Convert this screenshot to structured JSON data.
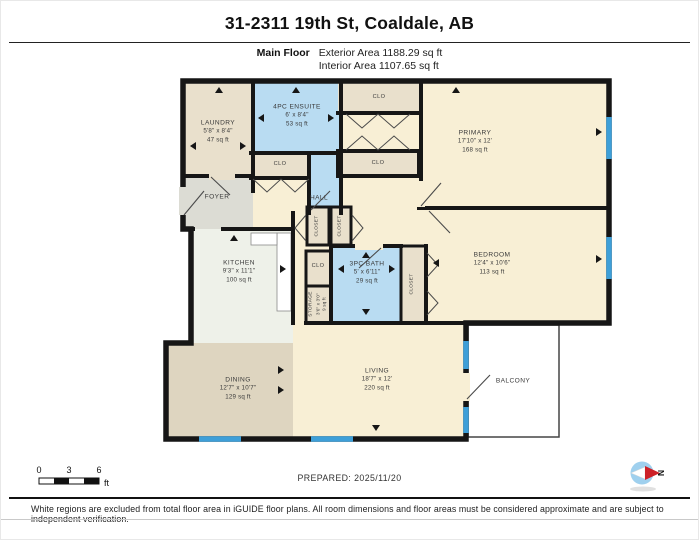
{
  "header": {
    "title": "31-2311 19th St, Coaldale, AB",
    "floor_label": "Main Floor",
    "exterior_area": "Exterior Area 1188.29 sq ft",
    "interior_area": "Interior Area 1107.65 sq ft"
  },
  "rooms": {
    "laundry": {
      "name": "LAUNDRY",
      "dims": "5'8\" x 8'4\"",
      "area": "47 sq ft"
    },
    "ensuite": {
      "name": "4PC ENSUITE",
      "dims": "6' x 8'4\"",
      "area": "53 sq ft"
    },
    "clo_top": {
      "name": "CLO"
    },
    "primary": {
      "name": "PRIMARY",
      "dims": "17'10\" x 12'",
      "area": "168 sq ft"
    },
    "clo_mid_left": {
      "name": "CLO"
    },
    "clo_mid_right": {
      "name": "CLO"
    },
    "foyer": {
      "name": "FOYER"
    },
    "hall": {
      "name": "HALL"
    },
    "closet_hall_1": {
      "name": "CLOSET"
    },
    "closet_hall_2": {
      "name": "CLOSET"
    },
    "kitchen": {
      "name": "KITCHEN",
      "dims": "9'3\" x 11'1\"",
      "area": "100 sq ft"
    },
    "clo_bath": {
      "name": "CLO"
    },
    "bath": {
      "name": "3PC BATH",
      "dims": "5' x 6'11\"",
      "area": "29 sq ft"
    },
    "storage": {
      "name": "STORAGE",
      "dims": "3'6\" x 3'0\"",
      "area": "9 sq ft"
    },
    "closet_bedroom": {
      "name": "CLOSET"
    },
    "bedroom": {
      "name": "BEDROOM",
      "dims": "12'4\" x 10'6\"",
      "area": "113 sq ft"
    },
    "dining": {
      "name": "DINING",
      "dims": "12'7\" x 10'7\"",
      "area": "129 sq ft"
    },
    "living": {
      "name": "LIVING",
      "dims": "18'7\" x 12'",
      "area": "220 sq ft"
    },
    "balcony": {
      "name": "BALCONY"
    }
  },
  "scale_bar": {
    "ticks": [
      "0",
      "3",
      "6"
    ],
    "unit": "ft"
  },
  "footer": {
    "prepared": "PREPARED: 2025/11/20",
    "disclaimer": "White regions are excluded from total floor area in iGUIDE floor plans. All room dimensions and floor areas must be considered approximate and are subject to independent verification.",
    "compass_label": "N"
  },
  "colors": {
    "wall": "#161616",
    "window": "#3e9fd8",
    "room_cream": "#f8efd5",
    "room_tan": "#e9e0cc",
    "room_grey": "#dcdcd4",
    "room_kitchen": "#eef1e9",
    "room_dining": "#ded5c0",
    "room_blue": "#b9dcf2",
    "balcony_white": "#ffffff",
    "compass_red": "#cc2027",
    "compass_blue": "#9fd0ee"
  }
}
